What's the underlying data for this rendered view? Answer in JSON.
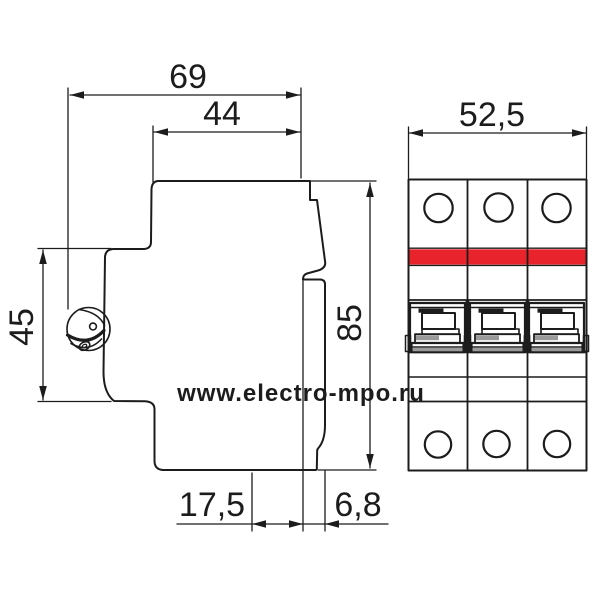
{
  "watermark": {
    "text": "www.electro-mpo.ru",
    "color": "#b7b7b7"
  },
  "views": {
    "side": {
      "dims": {
        "total_depth": "69",
        "front_depth": "44",
        "rail_section_height": "45",
        "overall_height": "85",
        "bottom_inset": "17,5",
        "front_inset": "6,8"
      }
    },
    "front": {
      "dims": {
        "overall_width": "52,5"
      },
      "poles": 3
    }
  },
  "colors": {
    "line": "#1c1c1c",
    "accent_red": "#e8232b",
    "toggle_gray": "#9a9a9a"
  }
}
